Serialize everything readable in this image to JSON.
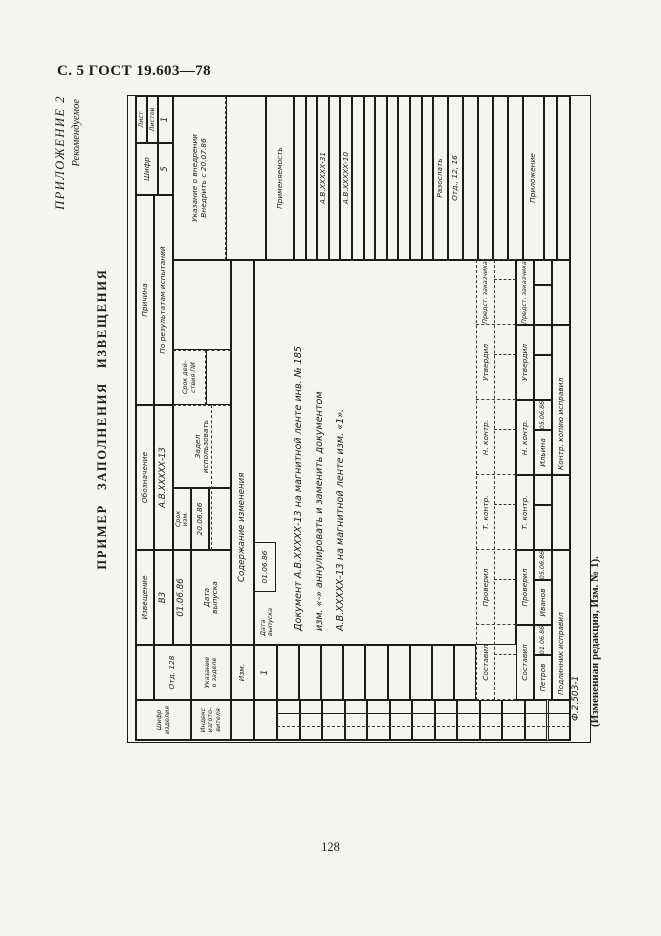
{
  "page": {
    "header": "С. 5 ГОСТ 19.603—78",
    "appendix_label": "ПРИЛОЖЕНИЕ 2",
    "appendix_sub": "Рекомендуемое",
    "title": "ПРИМЕР ЗАПОЛНЕНИЯ ИЗВЕЩЕНИЯ",
    "form_code": "Ф.2.503-1",
    "amendment_note": "(Измененная редакция, Изм. № 1).",
    "page_number": "128"
  },
  "colors": {
    "paper": "#f4f4f1",
    "ink": "#1c1c1c",
    "dashed_line": "#3a3a3a"
  },
  "form": {
    "orientation": "landscape sheet rotated 90deg counterclockwise on portrait page",
    "cells": [
      [
        0,
        0,
        40,
        55,
        "Шифр\nизделия",
        "f6",
        "cell-product-code-label"
      ],
      [
        0,
        55,
        40,
        40,
        "Индекс\nизгото-\nвителя",
        "f6",
        "cell-manufacturer-index-label"
      ],
      [
        40,
        0,
        55,
        18,
        "",
        "f7",
        "cell-blank"
      ],
      [
        40,
        18,
        55,
        37,
        "Отд. 128",
        "f7",
        "cell-department"
      ],
      [
        40,
        55,
        55,
        40,
        "Указание\nо заделе",
        "f6",
        "cell-stock-note-label"
      ],
      [
        95,
        0,
        95,
        18,
        "Извещение",
        "f7",
        "cell-notice-label"
      ],
      [
        95,
        18,
        95,
        19,
        "В3",
        "f8",
        "cell-notice-number"
      ],
      [
        190,
        0,
        145,
        18,
        "Обозначение",
        "f7",
        "cell-designation-label"
      ],
      [
        190,
        18,
        145,
        19,
        "А.В.ХХХХХ-13",
        "f8",
        "cell-designation-value"
      ],
      [
        335,
        0,
        210,
        18,
        "Причина",
        "f7",
        "cell-reason-label"
      ],
      [
        335,
        18,
        210,
        19,
        "По результатам испытаний",
        "f7",
        "cell-reason-value"
      ],
      [
        545,
        0,
        52,
        22,
        "Шифр",
        "f7",
        "cell-cipher-label"
      ],
      [
        545,
        22,
        52,
        15,
        "5",
        "f8",
        "cell-cipher-value"
      ],
      [
        597,
        0,
        47,
        11,
        "Лист",
        "f6",
        "cell-sheet-label"
      ],
      [
        597,
        11,
        47,
        11,
        "Листов",
        "f6",
        "cell-sheets-label"
      ],
      [
        597,
        22,
        47,
        15,
        "1",
        "f8",
        "cell-sheets-value"
      ],
      [
        95,
        37,
        95,
        18,
        "01.06.86",
        "f8",
        "cell-issue-date-value"
      ],
      [
        95,
        55,
        95,
        40,
        "Дата\nвыпуска",
        "f7",
        "cell-issue-date-label"
      ],
      [
        190,
        37,
        62,
        18,
        "Срок\nизм.",
        "f6",
        "cell-change-term-label"
      ],
      [
        190,
        55,
        62,
        18,
        "20.06.86",
        "f7",
        "cell-change-term-value"
      ],
      [
        190,
        73,
        62,
        22,
        "",
        "f7",
        "cell-blank"
      ],
      [
        252,
        37,
        83,
        58,
        "Задел\nиспользовать",
        "f7 d-r",
        "cell-stock-instruction"
      ],
      [
        335,
        37,
        55,
        33,
        "Срок дей-\nствия ПИ",
        "f6 d-r d-b",
        "cell-pi-validity-label"
      ],
      [
        335,
        70,
        55,
        25,
        "",
        "f7 d-r",
        "cell-blank"
      ],
      [
        390,
        37,
        90,
        58,
        "",
        "f7",
        "cell-blank"
      ],
      [
        480,
        37,
        164,
        53,
        "Указание о внедрении\nВнедрить с 20.07.86",
        "f7 d-b",
        "cell-implementation-note"
      ],
      [
        480,
        90,
        164,
        40,
        "",
        "f7",
        "cell-blank"
      ],
      [
        480,
        130,
        164,
        28,
        "Применяемость",
        "f7",
        "cell-applicability-header"
      ],
      [
        480,
        158,
        164,
        11.6,
        "",
        "f7",
        "cell-applicability-row"
      ],
      [
        480,
        169.6,
        164,
        11.6,
        "",
        "f7",
        "cell-applicability-row"
      ],
      [
        480,
        181.2,
        164,
        11.6,
        "А.В.ХХХХХ-31",
        "f7",
        "cell-applicability-entry"
      ],
      [
        480,
        192.8,
        164,
        11.6,
        "",
        "f7",
        "cell-applicability-row"
      ],
      [
        480,
        204.4,
        164,
        11.6,
        "А.В.ХХХХХ-10",
        "f7",
        "cell-applicability-entry"
      ],
      [
        480,
        216,
        164,
        11.6,
        "",
        "f7",
        "cell-applicability-row"
      ],
      [
        480,
        227.6,
        164,
        11.6,
        "",
        "f7",
        "cell-applicability-row"
      ],
      [
        480,
        239.2,
        164,
        11.6,
        "",
        "f7",
        "cell-applicability-row"
      ],
      [
        480,
        250.8,
        164,
        11.6,
        "",
        "f7",
        "cell-applicability-row"
      ],
      [
        480,
        262.4,
        164,
        11.6,
        "",
        "f7",
        "cell-applicability-row"
      ],
      [
        480,
        274,
        164,
        11.6,
        "",
        "f7",
        "cell-applicability-row"
      ],
      [
        480,
        285.6,
        164,
        11.4,
        "",
        "f7",
        "cell-applicability-row"
      ],
      [
        480,
        297,
        164,
        15,
        "Разослать",
        "f7",
        "cell-distribute-header"
      ],
      [
        480,
        312,
        164,
        15,
        "Отд., 12, 16",
        "f7",
        "cell-distribute-value"
      ],
      [
        480,
        327,
        164,
        15,
        "",
        "f7",
        "cell-distribute-row"
      ],
      [
        480,
        342,
        164,
        15,
        "",
        "f7",
        "cell-distribute-row"
      ],
      [
        480,
        357,
        164,
        15,
        "",
        "f7",
        "cell-distribute-row"
      ],
      [
        480,
        372,
        164,
        15,
        "",
        "f7",
        "cell-distribute-row"
      ],
      [
        480,
        387,
        164,
        21,
        "Приложение",
        "f7",
        "cell-attachment-header"
      ],
      [
        480,
        408,
        164,
        13,
        "",
        "f7",
        "cell-attachment-row"
      ],
      [
        480,
        421,
        164,
        13,
        "",
        "f7",
        "cell-attachment-row"
      ],
      [
        0,
        95,
        40,
        23,
        "",
        "f7",
        "cell-blank"
      ],
      [
        40,
        95,
        55,
        23,
        "Изм.",
        "f7",
        "cell-change-no-header"
      ],
      [
        95,
        95,
        385,
        23,
        "Содержание изменения",
        "f8 ind",
        "cell-change-content-header"
      ],
      [
        0,
        118,
        40,
        23,
        "",
        "f7",
        "cell-blank"
      ],
      [
        40,
        118,
        55,
        23,
        "1",
        "f8",
        "cell-change-no-value"
      ],
      [
        95,
        118,
        385,
        262,
        "",
        "f7",
        "cell-change-content-area"
      ],
      [
        100,
        121,
        46,
        20,
        "Дата\nвыпуска",
        "f6 nb al",
        "cell-inner-issue-date-label"
      ],
      [
        148,
        118,
        50,
        22,
        "01.06.86",
        "f7",
        "cell-inner-issue-date-value"
      ],
      [
        105,
        156,
        380,
        14,
        "Документ А.В.ХХХХХ-13 на магнитной ленте инв. № 185",
        "f9 nb al",
        "text-change-line-1"
      ],
      [
        105,
        177,
        380,
        14,
        "изм. «-» аннулировать и заменить документом",
        "f9 nb al",
        "text-change-line-2"
      ],
      [
        105,
        198,
        380,
        14,
        "А.В.ХХХХХ-13 на магнитной ленте изм. «1».",
        "f9 nb al",
        "text-change-line-3"
      ],
      [
        0,
        141,
        40,
        22.5,
        "",
        "f7",
        "cell-row"
      ],
      [
        0,
        163.5,
        40,
        22.5,
        "",
        "f7",
        "cell-row"
      ],
      [
        0,
        186.1,
        40,
        22.5,
        "",
        "f7",
        "cell-row"
      ],
      [
        0,
        208.6,
        40,
        22.5,
        "",
        "f7",
        "cell-row"
      ],
      [
        0,
        231.2,
        40,
        22.5,
        "",
        "f7",
        "cell-row"
      ],
      [
        0,
        253.7,
        40,
        22.5,
        "",
        "f7",
        "cell-row"
      ],
      [
        0,
        276.2,
        40,
        22.5,
        "",
        "f7",
        "cell-row"
      ],
      [
        0,
        298.8,
        40,
        22.5,
        "",
        "f7",
        "cell-row"
      ],
      [
        0,
        321.3,
        40,
        22.5,
        "",
        "f7",
        "cell-row"
      ],
      [
        0,
        343.9,
        40,
        22.5,
        "",
        "f7",
        "cell-row"
      ],
      [
        0,
        366.4,
        40,
        22.5,
        "",
        "f7",
        "cell-row"
      ],
      [
        0,
        388.9,
        40,
        22.6,
        "",
        "f7",
        "cell-row"
      ],
      [
        0,
        411.5,
        40,
        22.5,
        "",
        "f7",
        "cell-row"
      ],
      [
        40,
        141,
        55,
        22.1,
        "",
        "f7",
        "cell-row"
      ],
      [
        40,
        163.1,
        55,
        22.1,
        "",
        "f7",
        "cell-row"
      ],
      [
        40,
        185.2,
        55,
        22.1,
        "",
        "f7",
        "cell-row"
      ],
      [
        40,
        207.3,
        55,
        22.1,
        "",
        "f7",
        "cell-row"
      ],
      [
        40,
        229.4,
        55,
        22.2,
        "",
        "f7",
        "cell-row"
      ],
      [
        40,
        251.6,
        55,
        22.1,
        "",
        "f7",
        "cell-row"
      ],
      [
        40,
        273.7,
        55,
        22.1,
        "",
        "f7",
        "cell-row"
      ],
      [
        40,
        295.8,
        55,
        22.1,
        "",
        "f7",
        "cell-row"
      ],
      [
        40,
        317.9,
        55,
        22.1,
        "",
        "f7",
        "cell-row"
      ],
      [
        40,
        342,
        75,
        16,
        "Составил",
        "f7 nb",
        "sig-dashed-compiled"
      ],
      [
        115,
        342,
        75,
        16,
        "Проверил",
        "f7 nb",
        "sig-dashed-checked"
      ],
      [
        190,
        342,
        75,
        16,
        "Т. контр.",
        "f7 nb",
        "sig-dashed-tcontrol"
      ],
      [
        265,
        342,
        75,
        16,
        "Н. контр.",
        "f7 nb",
        "sig-dashed-ncontrol"
      ],
      [
        340,
        342,
        75,
        16,
        "Утвердил",
        "f7 nb",
        "sig-dashed-approved"
      ],
      [
        415,
        342,
        65,
        16,
        "Предст. заказчика",
        "f6 nb",
        "sig-dashed-customer-rep"
      ],
      [
        40,
        380,
        75,
        18,
        "Составил",
        "f7",
        "sig-compiled-label"
      ],
      [
        115,
        380,
        75,
        18,
        "Проверил",
        "f7",
        "sig-checked-label"
      ],
      [
        190,
        380,
        75,
        18,
        "Т. контр.",
        "f7",
        "sig-tcontrol-label"
      ],
      [
        265,
        380,
        75,
        18,
        "Н. контр.",
        "f7",
        "sig-ncontrol-label"
      ],
      [
        340,
        380,
        75,
        18,
        "Утвердил",
        "f7",
        "sig-approved-label"
      ],
      [
        415,
        380,
        65,
        18,
        "Предст. заказчика",
        "f6",
        "sig-customer-rep-label"
      ],
      [
        40,
        398,
        45,
        18,
        "Петров",
        "f7",
        "sig-compiled-name"
      ],
      [
        85,
        398,
        30,
        18,
        "01.06.86",
        "f6",
        "sig-compiled-date"
      ],
      [
        115,
        398,
        45,
        18,
        "Иванов",
        "f7",
        "sig-checked-name"
      ],
      [
        160,
        398,
        30,
        18,
        "05.06.86",
        "f6",
        "sig-checked-date"
      ],
      [
        190,
        398,
        45,
        18,
        "",
        "f7",
        "sig-blank"
      ],
      [
        235,
        398,
        30,
        18,
        "",
        "f7",
        "sig-blank"
      ],
      [
        265,
        398,
        45,
        18,
        "Ильина",
        "f7",
        "sig-ncontrol-name"
      ],
      [
        310,
        398,
        30,
        18,
        "05.06.86",
        "f6",
        "sig-ncontrol-date"
      ],
      [
        340,
        398,
        45,
        18,
        "",
        "f7",
        "sig-blank"
      ],
      [
        385,
        398,
        30,
        18,
        "",
        "f7",
        "sig-blank"
      ],
      [
        415,
        398,
        40,
        18,
        "",
        "f7",
        "sig-blank"
      ],
      [
        455,
        398,
        25,
        18,
        "",
        "f7",
        "sig-blank"
      ],
      [
        40,
        416,
        150,
        18,
        "Подлинник исправил",
        "f7 al",
        "cell-original-corrected"
      ],
      [
        190,
        416,
        75,
        18,
        "",
        "f7",
        "cell-blank"
      ],
      [
        265,
        416,
        150,
        18,
        "Контр. копию исправил",
        "f7 al",
        "cell-control-copy-corrected"
      ],
      [
        415,
        416,
        65,
        18,
        "",
        "f7",
        "cell-blank"
      ]
    ],
    "lines": [
      [
        13,
        141,
        293,
        "v",
        1
      ],
      [
        26,
        141,
        293,
        "v",
        0
      ],
      [
        190,
        75,
        145,
        "h",
        1
      ],
      [
        40,
        340,
        440,
        "h",
        1
      ],
      [
        40,
        358,
        440,
        "h",
        1
      ],
      [
        40,
        340,
        40,
        "v",
        1
      ],
      [
        115,
        340,
        40,
        "v",
        1
      ],
      [
        190,
        340,
        40,
        "v",
        1
      ],
      [
        265,
        340,
        40,
        "v",
        1
      ],
      [
        340,
        340,
        40,
        "v",
        1
      ],
      [
        415,
        340,
        40,
        "v",
        1
      ],
      [
        480,
        340,
        40,
        "v",
        1
      ],
      [
        85,
        358,
        22,
        "v",
        1
      ],
      [
        160,
        358,
        22,
        "v",
        1
      ],
      [
        235,
        358,
        22,
        "v",
        1
      ],
      [
        310,
        358,
        22,
        "v",
        1
      ],
      [
        385,
        358,
        22,
        "v",
        1
      ],
      [
        460,
        358,
        22,
        "v",
        1
      ]
    ]
  }
}
